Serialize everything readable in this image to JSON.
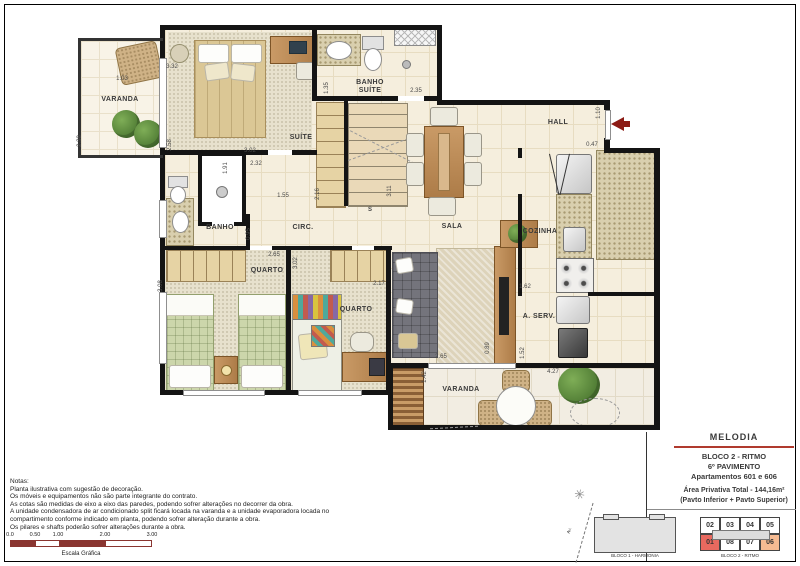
{
  "plan": {
    "rooms": {
      "varanda_tl": "VARANDA",
      "suite": "SUÍTE",
      "banho_suite": "BANHO SUÍTE",
      "hall": "HALL",
      "sala": "SALA",
      "cozinha": "COZINHA",
      "circ": "CIRC.",
      "banho": "BANHO",
      "quarto1": "QUARTO",
      "quarto2": "QUARTO",
      "aserv": "A. SERV.",
      "varanda_b": "VARANDA"
    },
    "stair_label": "S",
    "dims": [
      {
        "t": "1.03",
        "x": 122,
        "y": 79,
        "v": false
      },
      {
        "t": "2.38",
        "x": 80,
        "y": 141,
        "v": true
      },
      {
        "t": "3.32",
        "x": 172,
        "y": 67,
        "v": false
      },
      {
        "t": "2.58",
        "x": 170,
        "y": 145,
        "v": true
      },
      {
        "t": "3.02",
        "x": 250,
        "y": 151,
        "v": false
      },
      {
        "t": "1.91",
        "x": 226,
        "y": 168,
        "v": true
      },
      {
        "t": "2.32",
        "x": 256,
        "y": 164,
        "v": false
      },
      {
        "t": "1.35",
        "x": 327,
        "y": 88,
        "v": true
      },
      {
        "t": "2.35",
        "x": 416,
        "y": 91,
        "v": false
      },
      {
        "t": "1.55",
        "x": 283,
        "y": 196,
        "v": false
      },
      {
        "t": "2.16",
        "x": 318,
        "y": 194,
        "v": true
      },
      {
        "t": "0.95",
        "x": 249,
        "y": 234,
        "v": true
      },
      {
        "t": "2.65",
        "x": 274,
        "y": 255,
        "v": false
      },
      {
        "t": "3.08",
        "x": 161,
        "y": 286,
        "v": true
      },
      {
        "t": "3.02",
        "x": 296,
        "y": 263,
        "v": true
      },
      {
        "t": "2.17",
        "x": 379,
        "y": 284,
        "v": false
      },
      {
        "t": "3.11",
        "x": 390,
        "y": 191,
        "v": true
      },
      {
        "t": "1.10",
        "x": 599,
        "y": 113,
        "v": true
      },
      {
        "t": "0.47",
        "x": 592,
        "y": 145,
        "v": false
      },
      {
        "t": "1.62",
        "x": 525,
        "y": 287,
        "v": false
      },
      {
        "t": "0.89",
        "x": 488,
        "y": 348,
        "v": true
      },
      {
        "t": "2.65",
        "x": 441,
        "y": 357,
        "v": false
      },
      {
        "t": "1.52",
        "x": 523,
        "y": 353,
        "v": true
      },
      {
        "t": "4.27",
        "x": 553,
        "y": 372,
        "v": false
      },
      {
        "t": "1.42",
        "x": 425,
        "y": 377,
        "v": true
      }
    ]
  },
  "notes": {
    "title": "Notas:",
    "lines": [
      "Planta ilustrativa com sugestão de decoração.",
      "Os móveis e equipamentos não são parte integrante do contrato.",
      "As cotas são medidas de eixo a eixo das paredes, podendo sofrer alterações no decorrer da obra.",
      "A unidade condensadora de ar condicionado split ficará locada na varanda e a unidade evaporadora locada no",
      "compartimento conforme indicado em planta, podendo sofrer alteração durante a obra.",
      "Os pilares e shafts poderão sofrer alterações durante a obra."
    ]
  },
  "scale_bar": {
    "labels": [
      "0.0",
      "0.50",
      "1.00",
      "2.00",
      "3.00"
    ],
    "caption": "Escala Gráfica"
  },
  "title_block": {
    "project": "MELODIA",
    "block_line": "BLOCO 2 - RITMO",
    "floor_line": "6º  PAVIMENTO",
    "apartments_line": "Apartamentos 601 e 606",
    "area_line": "Área Privativa Total - 144,16m²",
    "area_sub": "(Pavto Inferior + Pavto Superior)"
  },
  "key_plan": {
    "bloco1_label": "BLOCO 1 - HARMONIA",
    "bloco2_label": "BLOCO 2 - RITMO",
    "street_label": "Av.",
    "units_top": [
      "02",
      "03",
      "04",
      "05"
    ],
    "units_bottom": [
      "01",
      "08",
      "07",
      "06"
    ],
    "highlight_strong": "01",
    "highlight_soft": "06",
    "compass": "✳"
  },
  "colors": {
    "entry_arrow": "#8c1b15",
    "underline_red": "#b03a2e",
    "scale_fill": "#8a3530",
    "unit_highlight": "#e8695f",
    "unit_highlight_soft": "#f6bb92"
  }
}
